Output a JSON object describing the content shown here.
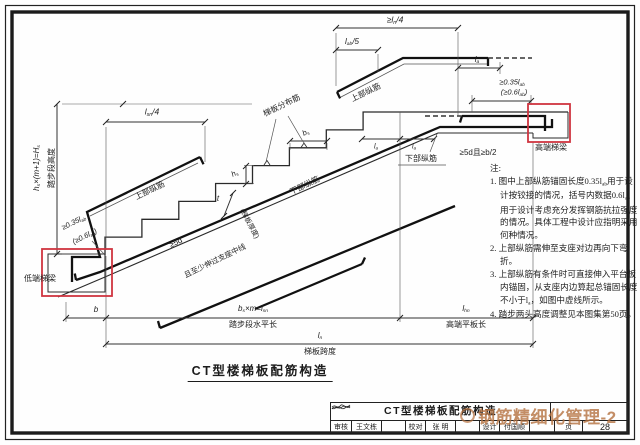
{
  "colors": {
    "highlight_red": "#cf3540",
    "watermark_orange": "#b5713f",
    "line": "#222222"
  },
  "figure": {
    "title": "CT型楼梯板配筋构造"
  },
  "watermark": {
    "text": "钢筋精细化管理-2",
    "logo": "circle-logo"
  },
  "labels": {
    "hs_total": "h_{s}×(m+1)=H_{s}",
    "step_height": "踏步段高度",
    "lsn4": "l_{sn}/4",
    "ln4": "≥l_{n}/4",
    "lab5": "l_{ab}/5",
    "la_top": "l_{a}",
    "la_1": "l_{a}",
    "la_2": "l_{a}",
    "anchor_035_high": "≥0.35l_{ab}",
    "anchor_06_high": "(≥0.6l_{ab})",
    "anchor_035_low": "≥0.35l_{ab}",
    "anchor_06_low": "(≥0.6l_{ab})",
    "high_beam": "高端梯梁",
    "low_beam": "低端梯梁",
    "sd_b2": "≥5d且≥b/2",
    "sd": "≥5d",
    "past_center": "且至少伸过支座中线",
    "top_bar_high": "上部纵筋",
    "top_bar_low": "上部纵筋",
    "dist_bar": "梯板分布筋",
    "bottom_bar_slope": "下部纵筋",
    "bottom_bar_flat": "下部纵筋",
    "t_label": "t",
    "t_note": "(梯板厚度)",
    "bs": "b_{s}",
    "hs": "h_{s}",
    "b": "b",
    "lsn_total": "b_{s}×m=l_{sn}",
    "lsn_text": "踏步段水平长",
    "lhn": "l_{hn}",
    "lhn_text": "高端平板长",
    "ln": "l_{n}",
    "ln_text": "梯板跨度"
  },
  "notes": {
    "heading": "注:",
    "items": [
      "1. 图中上部纵筋锚固长度0.35l_{ab}用于设计按铰接的情况，括号内数据0.6l_{ab}用于设计考虑充分发挥钢筋抗拉强度的情况。具体工程中设计应指明采用何种情况。",
      "2. 上部纵筋需伸至支座对边再向下弯折。",
      "3. 上部纵筋有条件时可直接伸入平台板内锚固，从支座内边算起总锚固长度不小于l_{a}，如图中虚线所示。",
      "4. 踏步两头高度调整见本图集第50页。"
    ]
  },
  "titleblock": {
    "title": "CT型楼梯板配筋构造",
    "reviewer_label": "审核",
    "reviewer": "王文栋",
    "checker_label": "校对",
    "checker": "张 明",
    "designer_label": "设计",
    "designer": "付国顺",
    "page_label": "页",
    "page_number": "28"
  }
}
